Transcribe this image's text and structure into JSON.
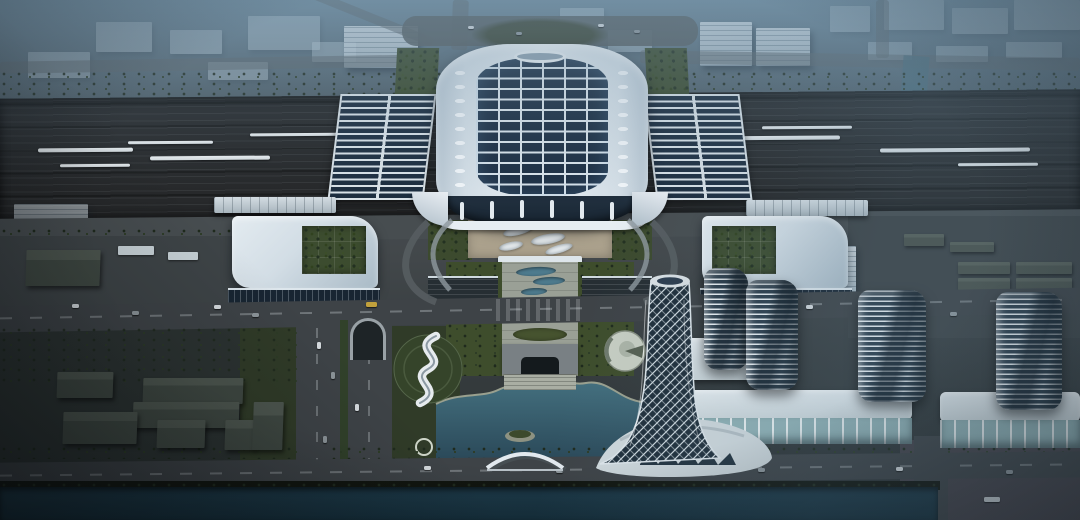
{
  "scene": {
    "type": "aerial-architectural-rendering",
    "subject": "Aerial dusk rendering of a futuristic high-speed railway station complex with a solar-roofed main hall over a rail yard, landscaped central axis, lake, twisted landmark tower and office towers",
    "view": "bird's-eye",
    "time_of_day": "dusk",
    "landmarks": [
      "station-main-hall",
      "platform-canopy",
      "rail-yard",
      "high-speed-train",
      "wing-building-green-courtyard",
      "forecourt-plaza",
      "landscaped-axis",
      "underpass-portal",
      "cross-boulevard",
      "tunnel-portal",
      "lake",
      "s-curve-pavilion",
      "round-pavilion",
      "twisted-landmark-tower",
      "arch-bridge",
      "louver-office-tower",
      "retail-podium",
      "canal",
      "city-blocks-in-haze"
    ]
  },
  "colors": {
    "haze_top": "#6e8a9c",
    "ground_mid": "#43484b",
    "ground_dark": "#2a3032",
    "rail_bed": "#27292b",
    "train_white": "#d6dcdf",
    "tree_dark": "#1f2a1d",
    "tree_mid": "#2d3c26",
    "roof_white": "#d2dde5",
    "roof_bright": "#e6edf2",
    "solar_panel": "#1e3044",
    "solar_rib": "#d9e3ea",
    "glass_dark": "#182532",
    "green_roof": "#3c4c2f",
    "lawn": "#3e4d2c",
    "pavement": "#9aa096",
    "forecourt_tan": "#a89e8a",
    "road": "#3e4347",
    "road_line": "#9fa6aa",
    "lake": "#3c6375",
    "lake_deep": "#2a4656",
    "canal": "#16303d",
    "shore": "#8d9282",
    "louver_light": "#e8eef2",
    "louver_dark": "#2d3e4c",
    "podium_white": "#ccd6da",
    "podium_glass": "#8fb0b4",
    "tower_glass": "#20303c",
    "diagrid_white": "#dfe6ea",
    "water_feature": "#4e7b8e",
    "bus_yellow": "#c2a13c",
    "vignette": "rgba(8,12,16,0.40)"
  }
}
